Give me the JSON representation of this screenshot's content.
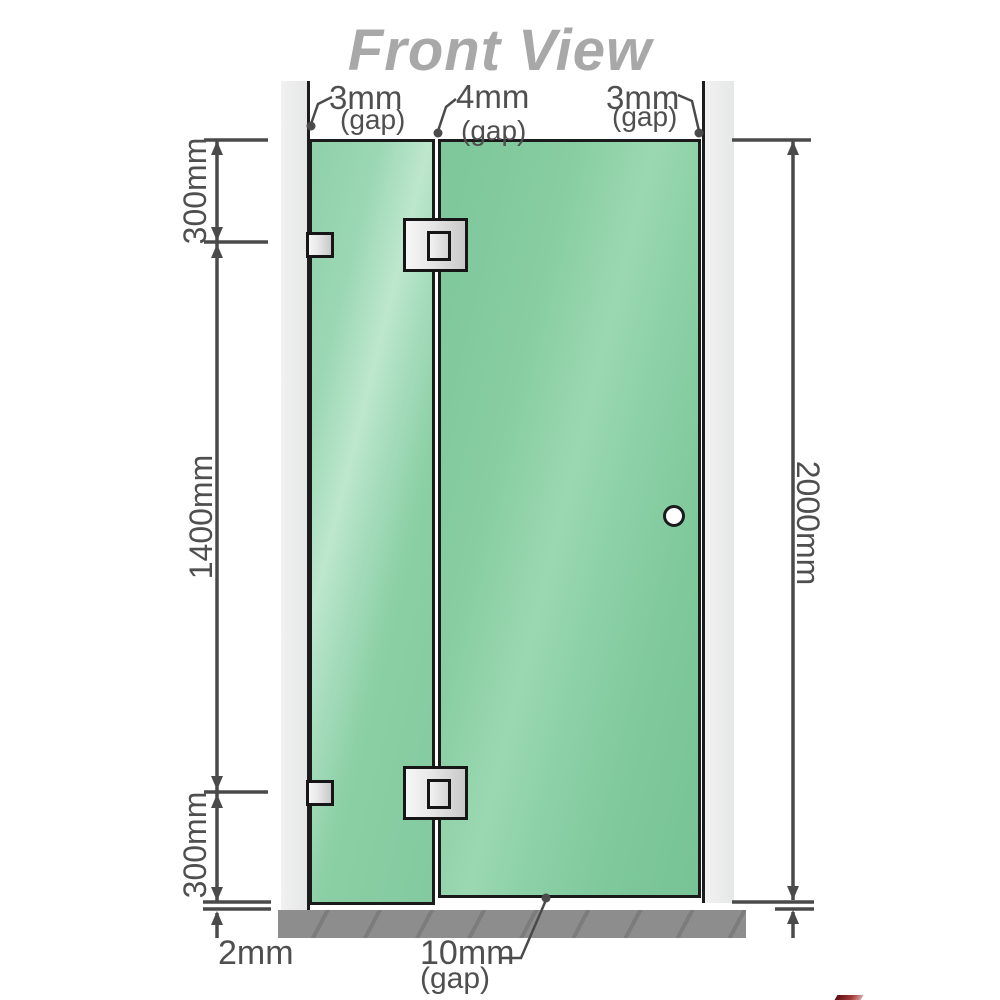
{
  "title": "Front View",
  "annotations": {
    "gap_left": {
      "value": "3mm",
      "unit": "(gap)"
    },
    "gap_middle": {
      "value": "4mm",
      "unit": "(gap)"
    },
    "gap_right": {
      "value": "3mm",
      "unit": "(gap)"
    },
    "gap_bottom": {
      "value": "10mm",
      "unit": "(gap)"
    },
    "floor_clearance": {
      "value": "2mm"
    }
  },
  "dimensions": {
    "top_hinge_offset": "300mm",
    "hinge_spacing": "1400mm",
    "bottom_hinge_offset": "300mm",
    "total_height": "2000mm"
  },
  "components": {
    "left_wall": "wall",
    "right_wall": "wall",
    "fixed_panel": "glass panel",
    "door_panel": "glass door panel",
    "hinge_count": 2,
    "wall_bracket_count": 2,
    "knob": "round door knob",
    "floor": "floor / hob"
  },
  "colors": {
    "glass_green": "#8ccfa5",
    "wall_gray": "#eaeaea",
    "floor_gray": "#8d8d8d",
    "outline_dark": "#1b1b1b",
    "dimension_gray": "#4a4a4a",
    "title_gray": "#a8a8a8"
  }
}
